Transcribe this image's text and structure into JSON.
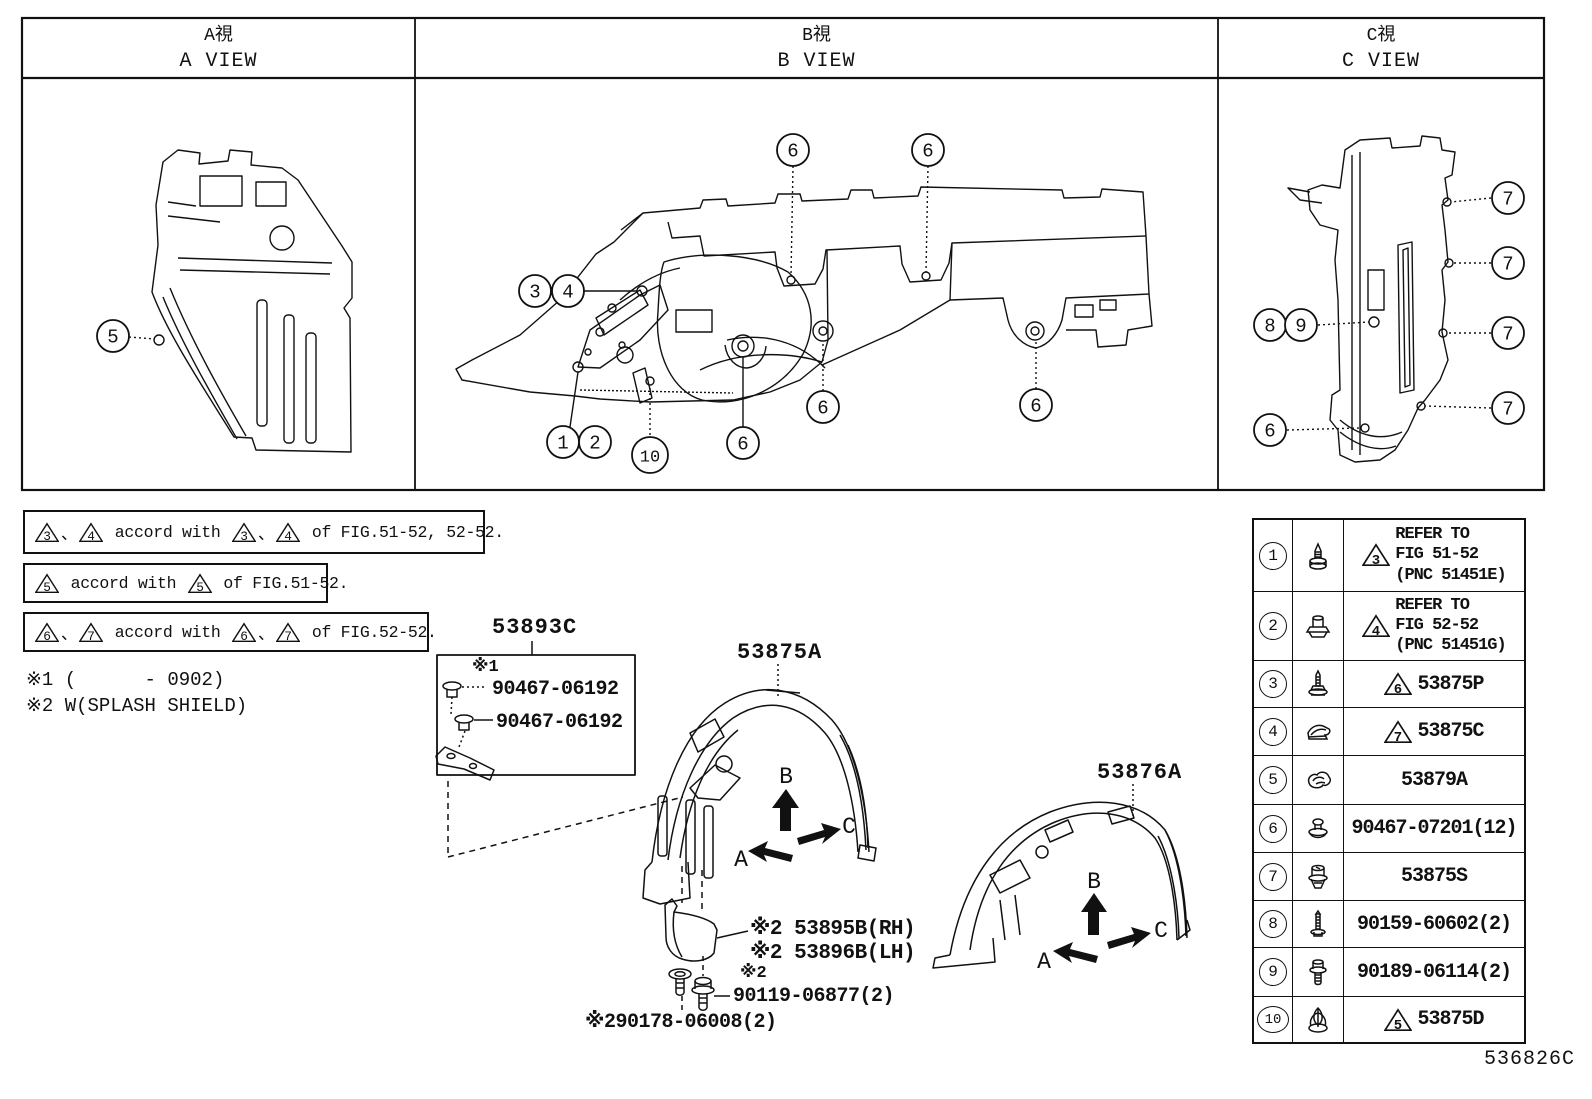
{
  "figure_code": "536826C",
  "header": {
    "views": [
      {
        "id": "a",
        "title_jp": "A視",
        "title_en": "A VIEW"
      },
      {
        "id": "b",
        "title_jp": "B視",
        "title_en": "B VIEW"
      },
      {
        "id": "c",
        "title_jp": "C視",
        "title_en": "C VIEW"
      }
    ]
  },
  "notes": [
    {
      "left": [
        "3",
        "4"
      ],
      "sep": "、",
      "mid": "accord with",
      "right": [
        "3",
        "4"
      ],
      "end": "of FIG.51-52, 52-52."
    },
    {
      "left": [
        "5"
      ],
      "sep": "、",
      "mid": "accord with",
      "right": [
        "5"
      ],
      "end": "of FIG.51-52."
    },
    {
      "left": [
        "6",
        "7"
      ],
      "sep": "、",
      "mid": "accord with",
      "right": [
        "6",
        "7"
      ],
      "end": "of FIG.52-52."
    }
  ],
  "footnotes": [
    "※1 (      - 0902)",
    "※2 W(SPLASH SHIELD)"
  ],
  "part_labels": {
    "bracket_assy": "53893C",
    "note1_mark": "※1",
    "clip_a": "90467-06192",
    "clip_b": "90467-06192",
    "liner_front": "53875A",
    "liner_rear": "53876A",
    "mudguard_rh": "※2 53895B(RH)",
    "mudguard_lh": "※2 53896B(LH)",
    "note2_mark": "※2",
    "bolt": "90119-06877(2)",
    "screw": "※290178-06008(2)"
  },
  "direction_labels": {
    "up": "B",
    "left": "A",
    "right": "C"
  },
  "callouts": {
    "a_view": [
      {
        "n": "5",
        "x": 113,
        "y": 336
      }
    ],
    "b_view": [
      {
        "n": "6",
        "x": 793,
        "y": 150
      },
      {
        "n": "6",
        "x": 928,
        "y": 150
      },
      {
        "n": "3",
        "x": 535,
        "y": 291
      },
      {
        "n": "4",
        "x": 568,
        "y": 291
      },
      {
        "n": "1",
        "x": 563,
        "y": 442
      },
      {
        "n": "2",
        "x": 595,
        "y": 442
      },
      {
        "n": "10",
        "x": 650,
        "y": 455
      },
      {
        "n": "6",
        "x": 743,
        "y": 443
      },
      {
        "n": "6",
        "x": 823,
        "y": 407
      },
      {
        "n": "6",
        "x": 1036,
        "y": 405
      }
    ],
    "c_view": [
      {
        "n": "7",
        "x": 1508,
        "y": 198
      },
      {
        "n": "7",
        "x": 1508,
        "y": 263
      },
      {
        "n": "7",
        "x": 1508,
        "y": 333
      },
      {
        "n": "7",
        "x": 1508,
        "y": 408
      },
      {
        "n": "8",
        "x": 1270,
        "y": 325
      },
      {
        "n": "9",
        "x": 1301,
        "y": 325
      },
      {
        "n": "6",
        "x": 1270,
        "y": 430
      }
    ]
  },
  "parts_table": {
    "rows": [
      {
        "num": "1",
        "icon": "screw-icon",
        "triangle": "3",
        "lines": [
          "REFER TO",
          "FIG 51-52",
          "(PNC 51451E)"
        ]
      },
      {
        "num": "2",
        "icon": "stud-clip-icon",
        "triangle": "4",
        "lines": [
          "REFER TO",
          "FIG 52-52",
          "(PNC 51451G)"
        ]
      },
      {
        "num": "3",
        "icon": "washer-screw-icon",
        "triangle": "6",
        "lines": [
          "53875P"
        ]
      },
      {
        "num": "4",
        "icon": "spring-clip-icon",
        "triangle": "7",
        "lines": [
          "53875C"
        ]
      },
      {
        "num": "5",
        "icon": "hook-clip-icon",
        "triangle": "",
        "lines": [
          "53879A"
        ]
      },
      {
        "num": "6",
        "icon": "grommet-clip-icon",
        "triangle": "",
        "lines": [
          "90467-07201(12)"
        ]
      },
      {
        "num": "7",
        "icon": "screw-grommet-icon",
        "triangle": "",
        "lines": [
          "53875S"
        ]
      },
      {
        "num": "8",
        "icon": "tapping-screw-icon",
        "triangle": "",
        "lines": [
          "90159-60602(2)"
        ]
      },
      {
        "num": "9",
        "icon": "bolt-icon",
        "triangle": "",
        "lines": [
          "90189-06114(2)"
        ]
      },
      {
        "num": "10",
        "icon": "expansion-clip-icon",
        "triangle": "5",
        "lines": [
          "53875D"
        ]
      }
    ]
  }
}
